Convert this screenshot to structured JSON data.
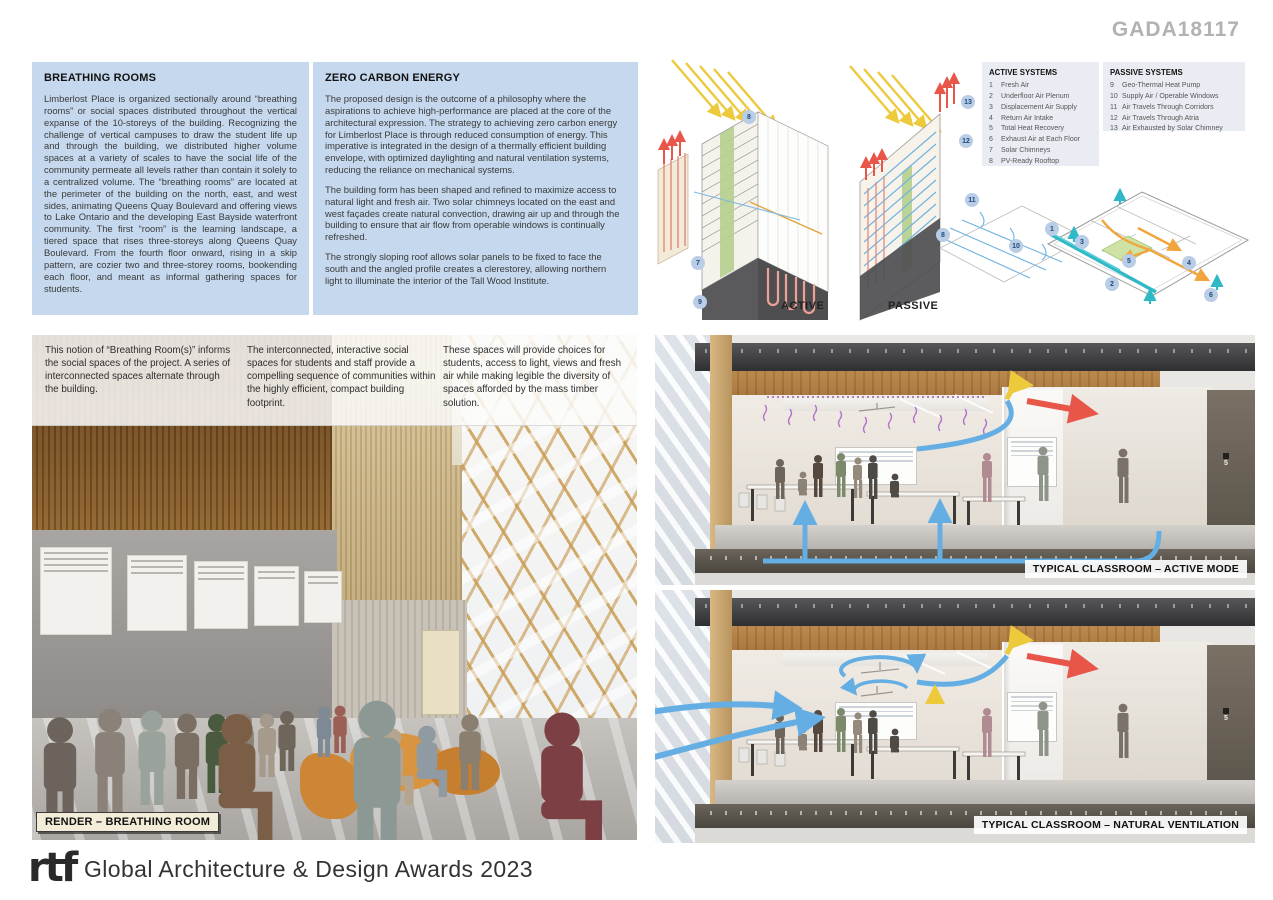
{
  "header": {
    "code": "GADA18117"
  },
  "panels": {
    "breathing_rooms": {
      "title": "BREATHING ROOMS",
      "body": "Limberlost Place is organized sectionally around “breathing rooms” or social spaces distributed throughout the vertical expanse of the 10-storeys of the building. Recognizing the challenge of vertical campuses to draw the student life up and through the building, we distributed higher volume spaces at a variety of scales to have the social life of the community permeate all levels rather than contain it solely to a centralized volume. The “breathing rooms” are located at the perimeter of the building on the north, east, and west sides, animating Queens Quay Boulevard and offering views to Lake Ontario and the developing East Bayside waterfront community. The first “room” is the learning landscape, a tiered space that rises three-storeys along Queens Quay Boulevard. From the fourth floor onward, rising in a skip pattern, are cozier two and three-storey rooms, bookending each floor, and meant as informal gathering spaces for students."
    },
    "zero_carbon": {
      "title": "ZERO CARBON ENERGY",
      "paragraphs": [
        "The proposed design is the outcome of a philosophy where the aspirations to achieve high-performance are placed at the core of the architectural expression. The strategy to achieving zero carbon energy for Limberlost Place is through reduced consumption of energy. This imperative is integrated in the design of a thermally efficient building envelope, with optimized daylighting and natural ventilation systems, reducing the reliance on mechanical systems.",
        "The building form has been shaped and refined to maximize access to natural light and fresh air. Two solar chimneys located on the east and west façades create natural convection, drawing air up and through the building to ensure that air flow from operable windows is continually refreshed.",
        "The strongly sloping roof allows solar panels to be fixed to face the south and the angled profile creates a clerestorey, allowing northern light to illuminate the interior of the Tall Wood Institute."
      ]
    }
  },
  "systems": {
    "active": {
      "title": "ACTIVE SYSTEMS",
      "items": [
        {
          "num": "1",
          "label": "Fresh Air"
        },
        {
          "num": "2",
          "label": "Underfloor Air Plenum"
        },
        {
          "num": "3",
          "label": "Displacement Air Supply"
        },
        {
          "num": "4",
          "label": "Return Air Intake"
        },
        {
          "num": "5",
          "label": "Total Heat Recovery"
        },
        {
          "num": "6",
          "label": "Exhaust Air at Each Floor"
        },
        {
          "num": "7",
          "label": "Solar Chimneys"
        },
        {
          "num": "8",
          "label": "PV-Ready Rooftop"
        }
      ]
    },
    "passive": {
      "title": "PASSIVE SYSTEMS",
      "items": [
        {
          "num": "9",
          "label": "Geo-Thermal Heat Pump"
        },
        {
          "num": "10",
          "label": "Supply Air / Operable Windows"
        },
        {
          "num": "11",
          "label": "Air Travels Through Corridors"
        },
        {
          "num": "12",
          "label": "Air Travels Through Atria"
        },
        {
          "num": "13",
          "label": "Air Exhausted by Solar Chimney"
        }
      ]
    }
  },
  "diagrams": {
    "active_label": "ACTIVE",
    "passive_label": "PASSIVE",
    "badges": [
      {
        "n": "8",
        "x": 99,
        "y": 65
      },
      {
        "n": "7",
        "x": 48,
        "y": 211
      },
      {
        "n": "9",
        "x": 50,
        "y": 250
      },
      {
        "n": "13",
        "x": 318,
        "y": 50
      },
      {
        "n": "12",
        "x": 316,
        "y": 89
      },
      {
        "n": "11",
        "x": 322,
        "y": 148
      },
      {
        "n": "8",
        "x": 293,
        "y": 183
      },
      {
        "n": "10",
        "x": 366,
        "y": 194
      },
      {
        "n": "1",
        "x": 402,
        "y": 177
      },
      {
        "n": "3",
        "x": 432,
        "y": 190
      },
      {
        "n": "5",
        "x": 479,
        "y": 209
      },
      {
        "n": "2",
        "x": 462,
        "y": 232
      },
      {
        "n": "4",
        "x": 539,
        "y": 211
      },
      {
        "n": "6",
        "x": 561,
        "y": 243
      }
    ]
  },
  "overlay": {
    "col1": "This notion of “Breathing Room(s)” informs the social spaces of the project. A series of interconnected spaces alternate through the building.",
    "col2": "The interconnected, interactive social spaces for students and staff provide a compelling sequence of communities within the highly efficient, compact building footprint.",
    "col3": "These spaces will provide choices for students, access to light, views and fresh air while making legible the diversity of spaces afforded by the mass timber solution."
  },
  "labels": {
    "render": "RENDER – BREATHING ROOM",
    "classroom_active": "TYPICAL CLASSROOM – ACTIVE MODE",
    "classroom_natural": "TYPICAL CLASSROOM – NATURAL VENTILATION",
    "room_number": "5"
  },
  "footer": {
    "logo": "rtf",
    "text": "Global Architecture & Design Awards 2023"
  },
  "colors": {
    "bluebox_bg": "#c5d8ed",
    "legend_bg": "#e9edf3",
    "badge_bg": "#b9cde6",
    "arrow_blue": "#64aee3",
    "arrow_red": "#e8564a",
    "arrow_yellow": "#edc93c",
    "arrow_orange": "#f0a63c",
    "arrow_teal": "#2fb9c7",
    "squiggle_purple": "#b173cc",
    "header_gray": "#b2b2b2"
  }
}
